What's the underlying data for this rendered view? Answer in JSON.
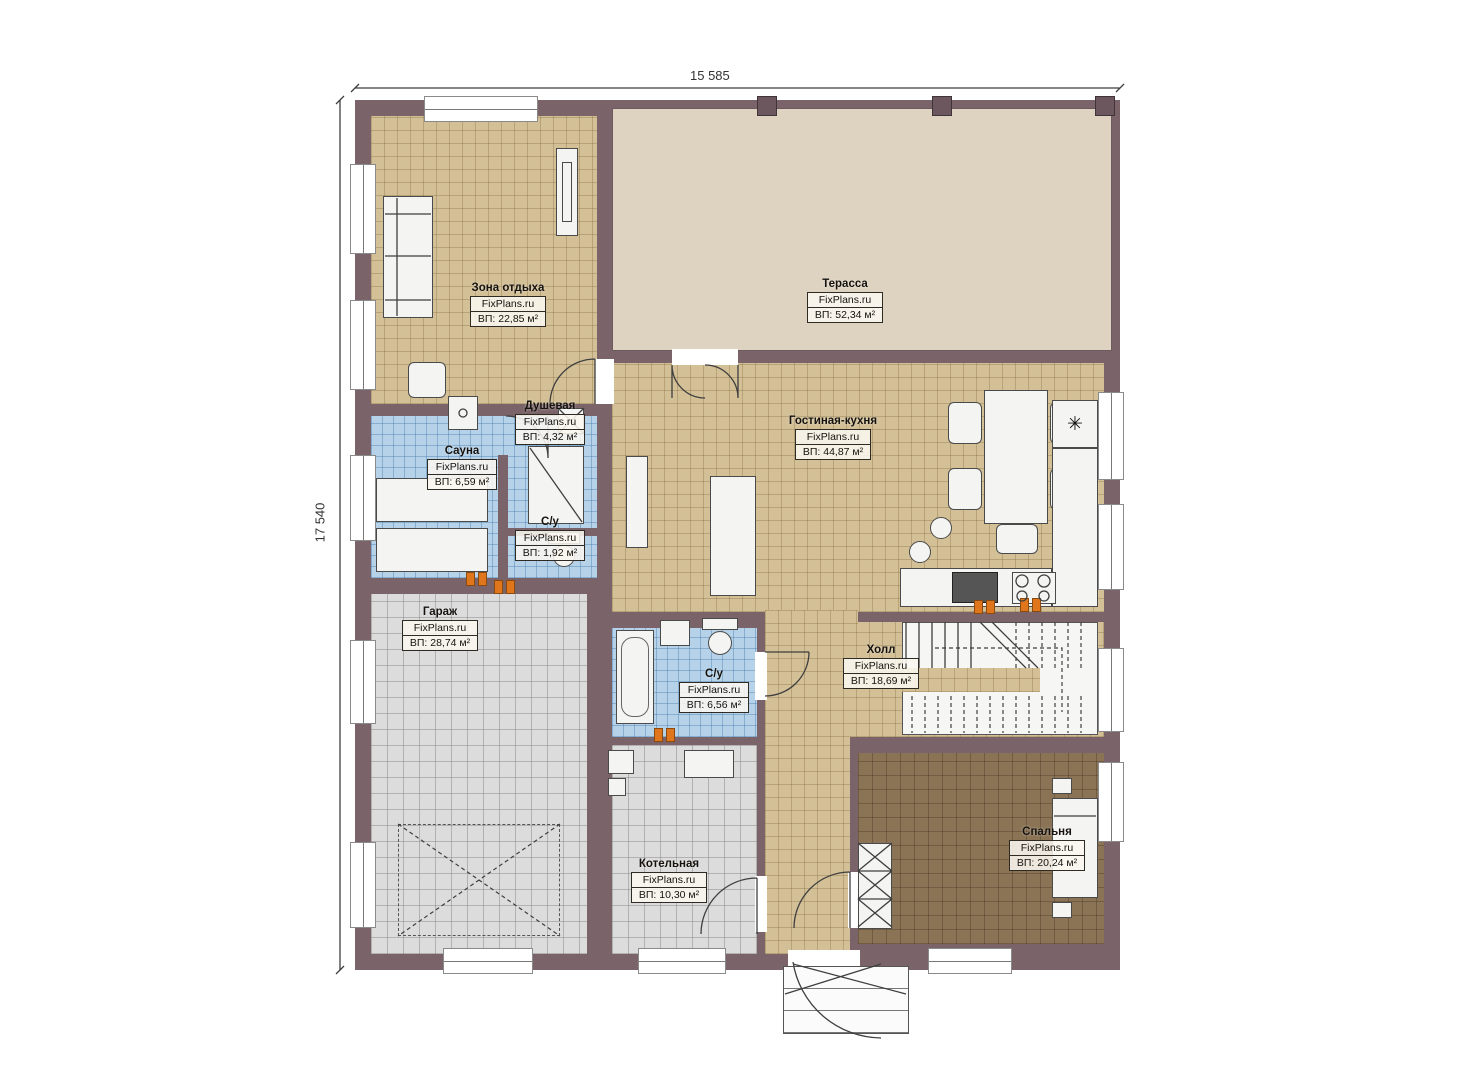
{
  "brand": "FixPlans.ru",
  "dimensions": {
    "top": "15 585",
    "left": "17 540"
  },
  "rooms": {
    "lounge": {
      "name": "Зона отдыха",
      "area": "ВП: 22,85 м²"
    },
    "terrace": {
      "name": "Терасса",
      "area": "ВП: 52,34 м²"
    },
    "living_kitchen": {
      "name": "Гостиная-кухня",
      "area": "ВП: 44,87 м²"
    },
    "sauna": {
      "name": "Сауна",
      "area": "ВП: 6,59 м²"
    },
    "shower": {
      "name": "Душевая",
      "area": "ВП: 4,32 м²"
    },
    "wc_small": {
      "name": "С/у",
      "area": "ВП: 1,92 м²"
    },
    "garage": {
      "name": "Гараж",
      "area": "ВП: 28,74 м²"
    },
    "bathroom": {
      "name": "С/у",
      "area": "ВП: 6,56 м²"
    },
    "hall": {
      "name": "Холл",
      "area": "ВП: 18,69 м²"
    },
    "boiler": {
      "name": "Котельная",
      "area": "ВП: 10,30 м²"
    },
    "bedroom": {
      "name": "Спальня",
      "area": "ВП: 20,24 м²"
    }
  },
  "symbols": {
    "snowflake": "✳"
  },
  "colors": {
    "wall": "#7b6469",
    "terrace_floor": "#ddd3c0",
    "tile_tan": "#d3c097",
    "tile_blue": "#b5d2e9",
    "tile_gray": "#dcdcdc",
    "bedroom_floor": "#8b7456",
    "accent_orange": "#e0761c"
  }
}
